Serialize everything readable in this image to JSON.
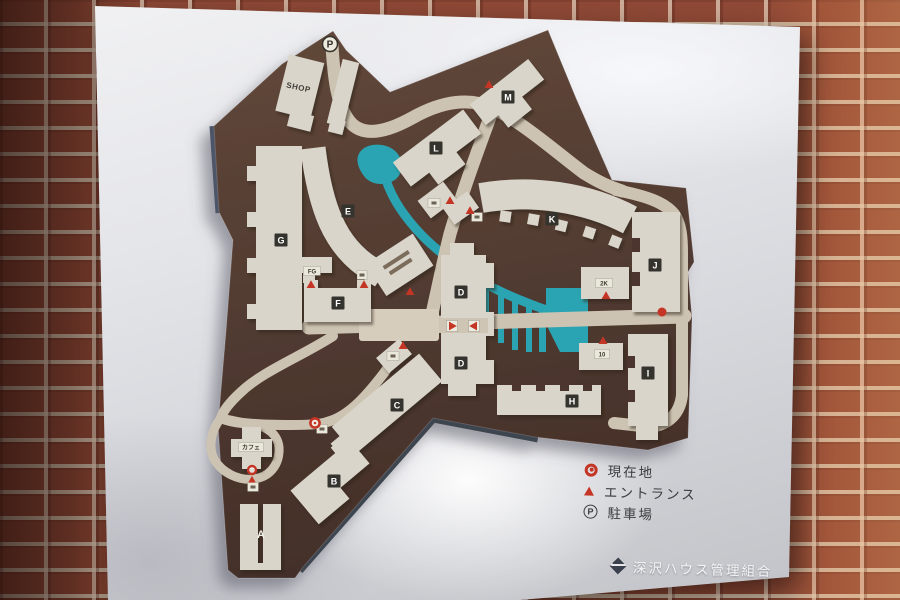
{
  "legend": {
    "items": [
      {
        "icon": "current-location",
        "label": "現在地"
      },
      {
        "icon": "entrance",
        "label": "エントランス"
      },
      {
        "icon": "parking",
        "label": "駐車場",
        "icon_letter": "P"
      }
    ]
  },
  "signature": {
    "text": "深沢ハウス管理組合"
  },
  "map": {
    "colors": {
      "land": "#4c362e",
      "road": "#cdc3b2",
      "water": "#2aa4b2",
      "building": "#d9d5ca",
      "chip_bg": "#34332e",
      "chip_fg": "#ffffff",
      "red": "#c43525",
      "box_bg": "#eae7db",
      "box_fg": "#3f3a30"
    },
    "shop_label": {
      "text": "SHOP",
      "x": 298,
      "y": 90,
      "rotate": 12
    },
    "chips": [
      {
        "label": "A",
        "x": 261,
        "y": 534,
        "plain": true
      },
      {
        "label": "B",
        "x": 334,
        "y": 481
      },
      {
        "label": "C",
        "x": 397,
        "y": 405
      },
      {
        "label": "D",
        "x": 461,
        "y": 292
      },
      {
        "label": "D",
        "x": 461,
        "y": 363
      },
      {
        "label": "E",
        "x": 348,
        "y": 211
      },
      {
        "label": "F",
        "x": 338,
        "y": 303
      },
      {
        "label": "G",
        "x": 281,
        "y": 240
      },
      {
        "label": "H",
        "x": 572,
        "y": 401
      },
      {
        "label": "I",
        "x": 648,
        "y": 373
      },
      {
        "label": "J",
        "x": 655,
        "y": 265
      },
      {
        "label": "K",
        "x": 552,
        "y": 219
      },
      {
        "label": "L",
        "x": 436,
        "y": 148
      },
      {
        "label": "M",
        "x": 508,
        "y": 97
      }
    ],
    "boxes": [
      {
        "label": "FG",
        "x": 312,
        "y": 271,
        "w": 17
      },
      {
        "label": "2K",
        "x": 604,
        "y": 283,
        "w": 17
      },
      {
        "label": "10",
        "x": 602,
        "y": 354,
        "w": 15
      },
      {
        "label": "カフェ",
        "x": 251,
        "y": 447,
        "w": 25
      },
      {
        "label": "",
        "x": 362,
        "y": 275,
        "w": 10
      },
      {
        "label": "",
        "x": 434,
        "y": 203,
        "w": 12
      },
      {
        "label": "",
        "x": 477,
        "y": 217,
        "w": 11
      },
      {
        "label": "",
        "x": 393,
        "y": 356,
        "w": 12
      },
      {
        "label": "",
        "x": 322,
        "y": 429,
        "w": 11
      },
      {
        "label": "",
        "x": 253,
        "y": 487,
        "w": 11
      }
    ],
    "markers": [
      {
        "type": "parking",
        "x": 330,
        "y": 44,
        "label": "P"
      },
      {
        "type": "entrance",
        "x": 489,
        "y": 85
      },
      {
        "type": "entrance",
        "x": 450,
        "y": 201
      },
      {
        "type": "entrance",
        "x": 470,
        "y": 211
      },
      {
        "type": "entrance",
        "x": 410,
        "y": 292
      },
      {
        "type": "entrance",
        "x": 311,
        "y": 285
      },
      {
        "type": "entrance",
        "x": 364,
        "y": 285
      },
      {
        "type": "entrance",
        "x": 403,
        "y": 346
      },
      {
        "type": "entrance",
        "x": 606,
        "y": 296
      },
      {
        "type": "entrance",
        "x": 603,
        "y": 341
      },
      {
        "type": "entrance-chip-right",
        "x": 452,
        "y": 326
      },
      {
        "type": "entrance-chip-left",
        "x": 474,
        "y": 326
      },
      {
        "type": "red-dot",
        "x": 662,
        "y": 312
      },
      {
        "type": "current-location",
        "x": 315,
        "y": 423
      },
      {
        "type": "current-location-entrance",
        "x": 252,
        "y": 474
      }
    ]
  }
}
